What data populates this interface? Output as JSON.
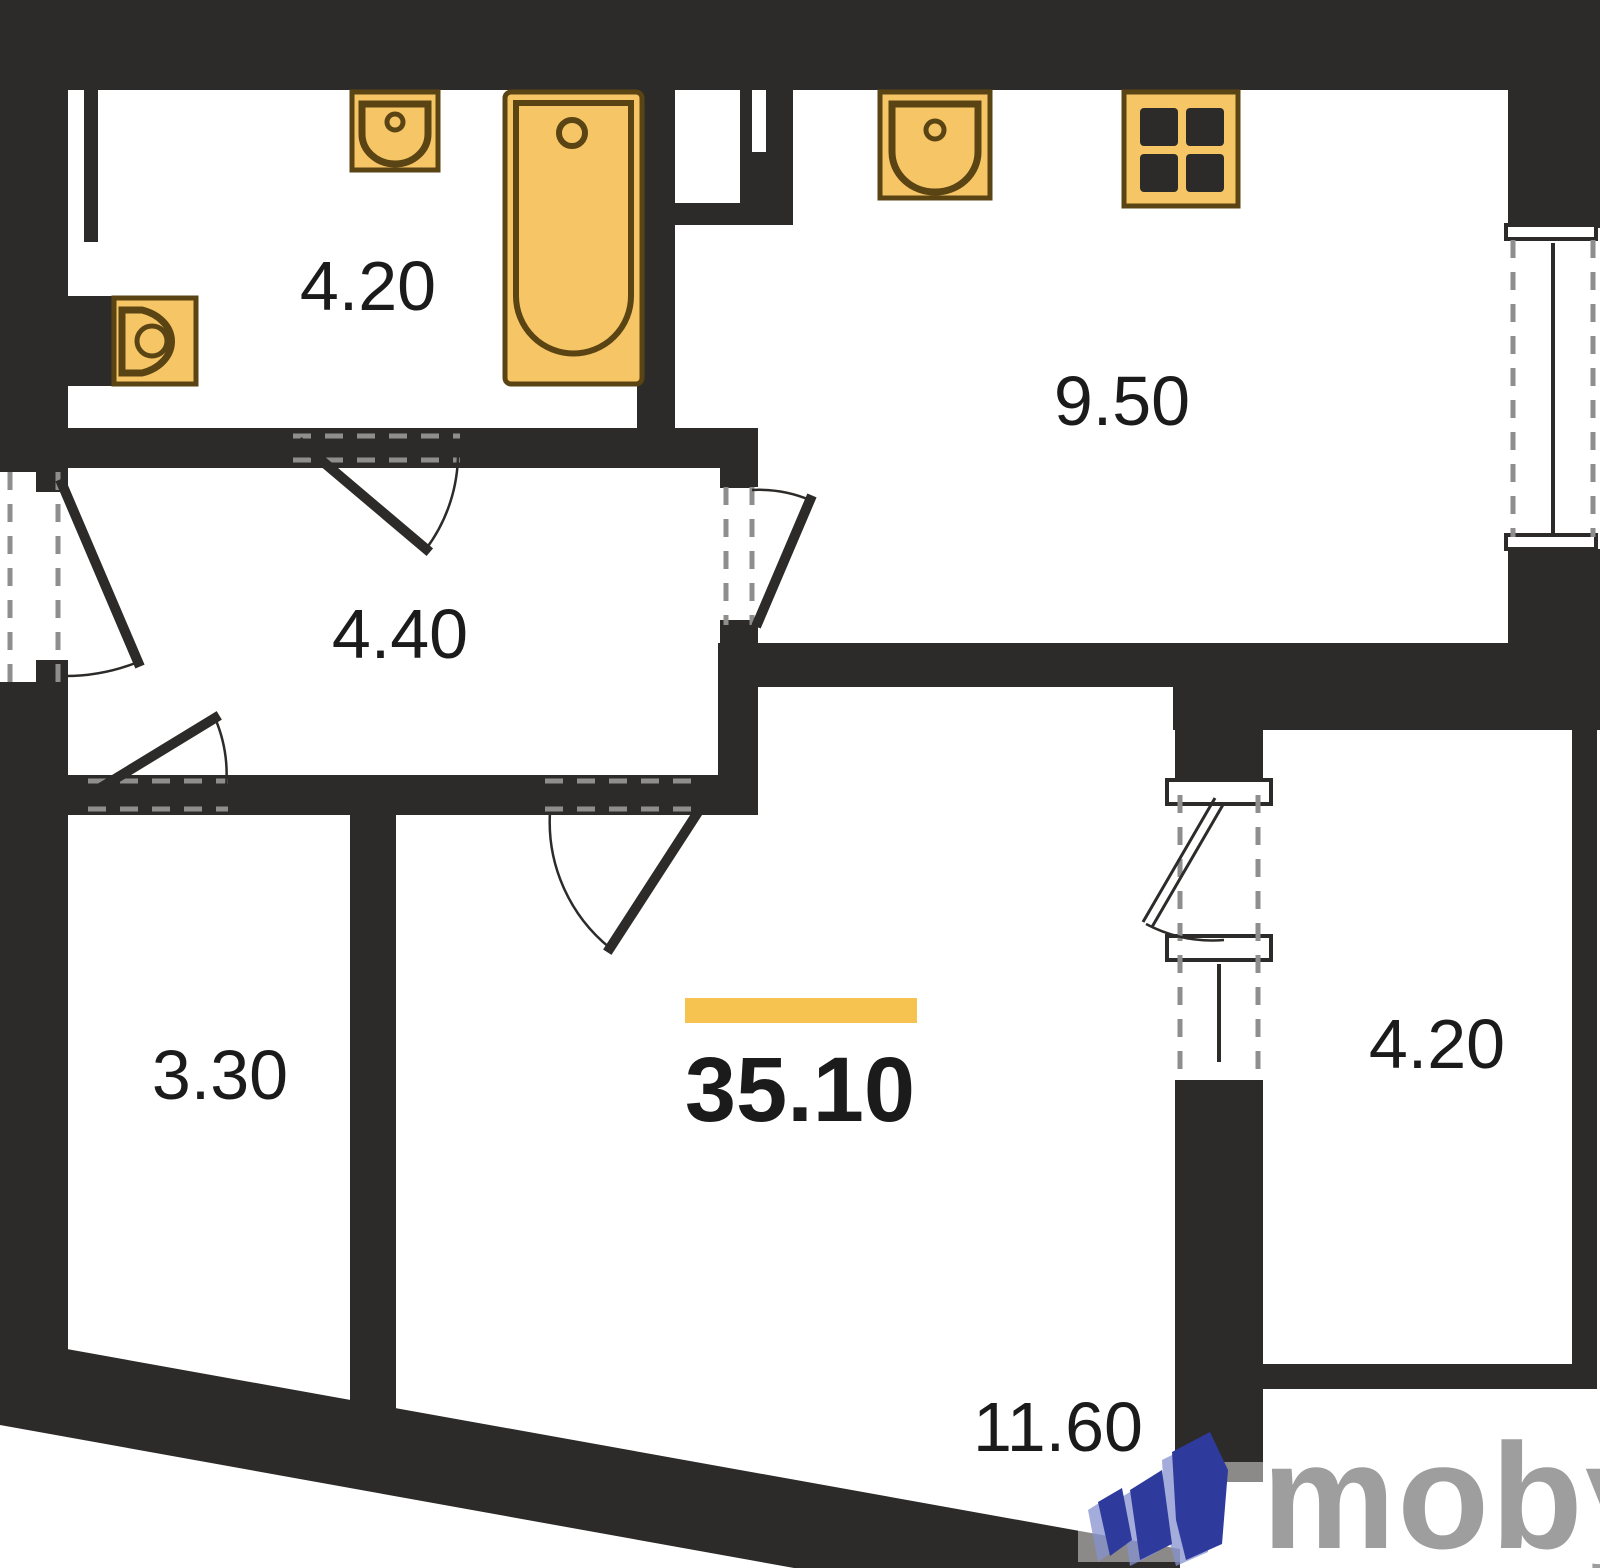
{
  "plan": {
    "title": "apartment floor plan",
    "total_area": "35.10",
    "rooms": [
      {
        "id": "bathroom",
        "area": "4.20"
      },
      {
        "id": "kitchen",
        "area": "9.50"
      },
      {
        "id": "hallway",
        "area": "4.40"
      },
      {
        "id": "storage",
        "area": "3.30"
      },
      {
        "id": "living-room",
        "area": "11.60"
      },
      {
        "id": "balcony",
        "area": "4.20"
      }
    ],
    "fixtures": [
      "toilet",
      "bathroom-washbasin",
      "bathtub",
      "kitchen-washbasin",
      "stove"
    ],
    "colors": {
      "wall": "#2d2b29",
      "fixture_fill": "#f5c566",
      "fixture_stroke": "#5a4414",
      "accent_bar": "#f6c350",
      "dash": "#8e8e8e",
      "label": "#1b1b1b",
      "logo_text": "#9e9e9e",
      "logo_blue": "#2e3a9c",
      "logo_blue_light": "#8691cf"
    }
  },
  "watermark": {
    "text": "moby"
  }
}
